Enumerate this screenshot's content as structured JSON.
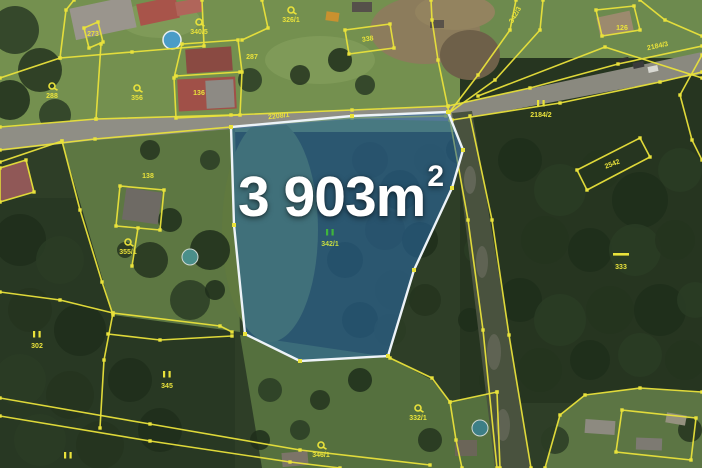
{
  "main_parcel": {
    "area_value": "3 903m",
    "area_superscript": "2",
    "marker": "II",
    "parcel_number": "342/1"
  },
  "parcel_labels": [
    {
      "text": "326/1",
      "x": 291,
      "y": 22,
      "rot": 0,
      "marker": "balloon"
    },
    {
      "text": "340/5",
      "x": 199,
      "y": 34,
      "rot": 0,
      "marker": "balloon"
    },
    {
      "text": "287",
      "x": 252,
      "y": 59,
      "rot": 0,
      "marker": null
    },
    {
      "text": "288",
      "x": 52,
      "y": 98,
      "rot": 0,
      "marker": "balloon"
    },
    {
      "text": "273",
      "x": 93,
      "y": 36,
      "rot": 0,
      "marker": null
    },
    {
      "text": "136",
      "x": 199,
      "y": 95,
      "rot": 0,
      "marker": null
    },
    {
      "text": "356",
      "x": 137,
      "y": 100,
      "rot": 0,
      "marker": "balloon"
    },
    {
      "text": "2208/1",
      "x": 279,
      "y": 118,
      "rot": -7,
      "marker": null
    },
    {
      "text": "338",
      "x": 368,
      "y": 41,
      "rot": -8,
      "marker": null
    },
    {
      "text": "342/3",
      "x": 517,
      "y": 16,
      "rot": -60,
      "marker": null
    },
    {
      "text": "126",
      "x": 622,
      "y": 30,
      "rot": 0,
      "marker": null
    },
    {
      "text": "2184/3",
      "x": 658,
      "y": 48,
      "rot": -12,
      "marker": null
    },
    {
      "text": "2184/2",
      "x": 541,
      "y": 117,
      "rot": 0,
      "marker": "ii"
    },
    {
      "text": "2542",
      "x": 613,
      "y": 166,
      "rot": -21,
      "marker": null
    },
    {
      "text": "333",
      "x": 621,
      "y": 269,
      "rot": 0,
      "marker": "dash"
    },
    {
      "text": "138",
      "x": 148,
      "y": 178,
      "rot": 0,
      "marker": null
    },
    {
      "text": "355/1",
      "x": 128,
      "y": 254,
      "rot": 0,
      "marker": "balloon"
    },
    {
      "text": "302",
      "x": 37,
      "y": 348,
      "rot": 0,
      "marker": "ii"
    },
    {
      "text": "345",
      "x": 167,
      "y": 388,
      "rot": 0,
      "marker": "ii"
    },
    {
      "text": "332/1",
      "x": 418,
      "y": 420,
      "rot": 0,
      "marker": "balloon"
    },
    {
      "text": "346/1",
      "x": 321,
      "y": 457,
      "rot": 0,
      "marker": "balloon"
    },
    {
      "text": "",
      "x": 68,
      "y": 469,
      "rot": 0,
      "marker": "ii"
    },
    {
      "text": "342/1",
      "x": 330,
      "y": 246,
      "rot": 0,
      "marker": "ii-green",
      "color": "#c8dd40"
    }
  ],
  "colors": {
    "boundary_yellow": "#e9e23b",
    "label_yellow": "#e9e23b",
    "highlight_fill": "#2a69a5",
    "highlight_border": "#edf3f8",
    "marker_green": "#3fb53b",
    "area_text": "#ffffff"
  }
}
